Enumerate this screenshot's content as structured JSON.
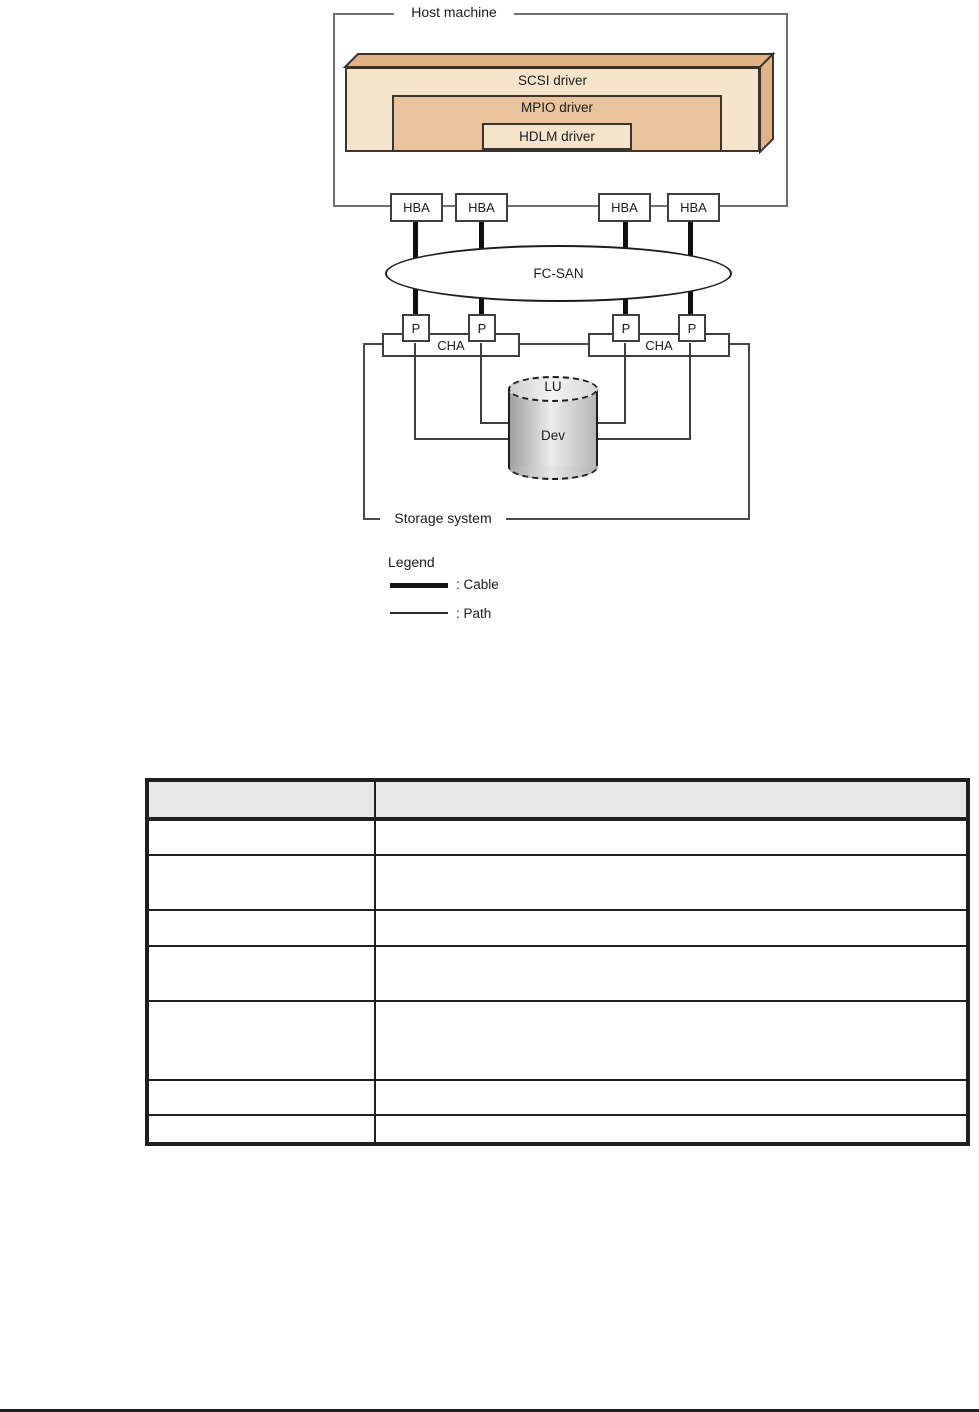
{
  "diagram": {
    "host_box_label": "Host machine",
    "scsi_driver_label": "SCSI driver",
    "mpio_driver_label": "MPIO driver",
    "hdlm_driver_label": "HDLM driver",
    "hba_label": "HBA",
    "fc_san_label": "FC-SAN",
    "port_label": "P",
    "cha_label": "CHA",
    "lu_label": "LU",
    "dev_label": "Dev",
    "storage_box_label": "Storage system",
    "legend": {
      "title": "Legend",
      "cable_label": ": Cable",
      "path_label": ": Path"
    },
    "colors": {
      "driver_front_fill": "#f6e3cc",
      "driver_3d_fill": "#e0b286",
      "mpio_fill": "#e9c39b",
      "cable_line": "#101010",
      "path_line": "#3f3f3f"
    }
  },
  "table": {
    "columns": 2,
    "header_fill": "#e8e8e8",
    "header_cells": [
      "",
      ""
    ],
    "rows": [
      [
        "",
        ""
      ],
      [
        "",
        ""
      ],
      [
        "",
        ""
      ],
      [
        "",
        ""
      ],
      [
        "",
        ""
      ],
      [
        "",
        ""
      ],
      [
        "",
        ""
      ]
    ]
  }
}
